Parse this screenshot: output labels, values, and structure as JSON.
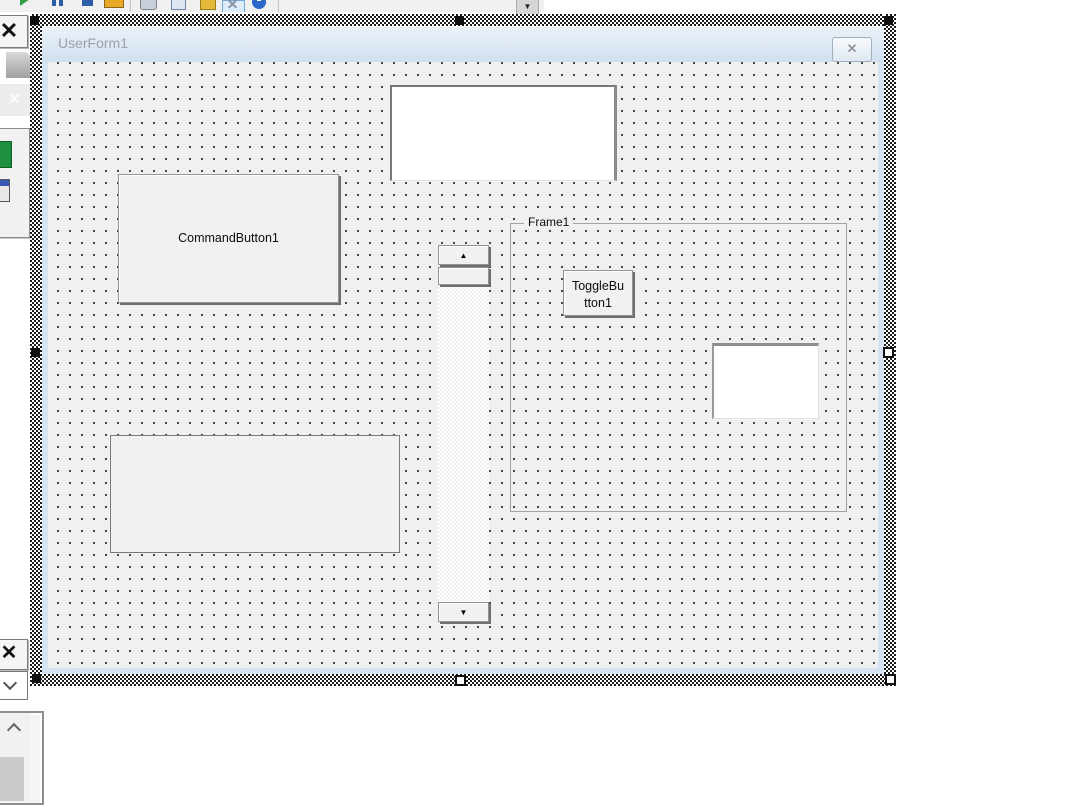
{
  "toolbar": {
    "icons": [
      "run-icon",
      "break-icon",
      "reset-icon",
      "design-mode-icon",
      "project-explorer-icon",
      "properties-window-icon",
      "toolbox-icon",
      "toolbox-toggle-selected-icon",
      "help-icon"
    ],
    "scroll_down_glyph": "▼"
  },
  "left_panel": {
    "toolbox_close_glyph": "✕",
    "faint_pointer_glyph": "✕",
    "properties_close_glyph": "✕"
  },
  "designer": {
    "form": {
      "title": "UserForm1",
      "close_glyph": "✕"
    }
  },
  "controls": {
    "textbox1": {
      "value": ""
    },
    "command_button1": {
      "label": "CommandButton1"
    },
    "scrollbar1": {
      "up_glyph": "▲",
      "down_glyph": "▼"
    },
    "frame1": {
      "caption": "Frame1"
    },
    "toggle_button1": {
      "line1": "ToggleBu",
      "line2": "tton1"
    },
    "textbox2": {
      "value": ""
    },
    "label1": {
      "value": ""
    }
  },
  "colors": {
    "form_background": "#f0f0f0",
    "titlebar_top": "#ecf2f9",
    "titlebar_bottom": "#d0dfee",
    "window_frame_blue": "#d5e2f1",
    "title_text": "#9aa2ac",
    "control_shadow": "#6f6f6f",
    "selected_tool_border": "#74a9dc"
  }
}
